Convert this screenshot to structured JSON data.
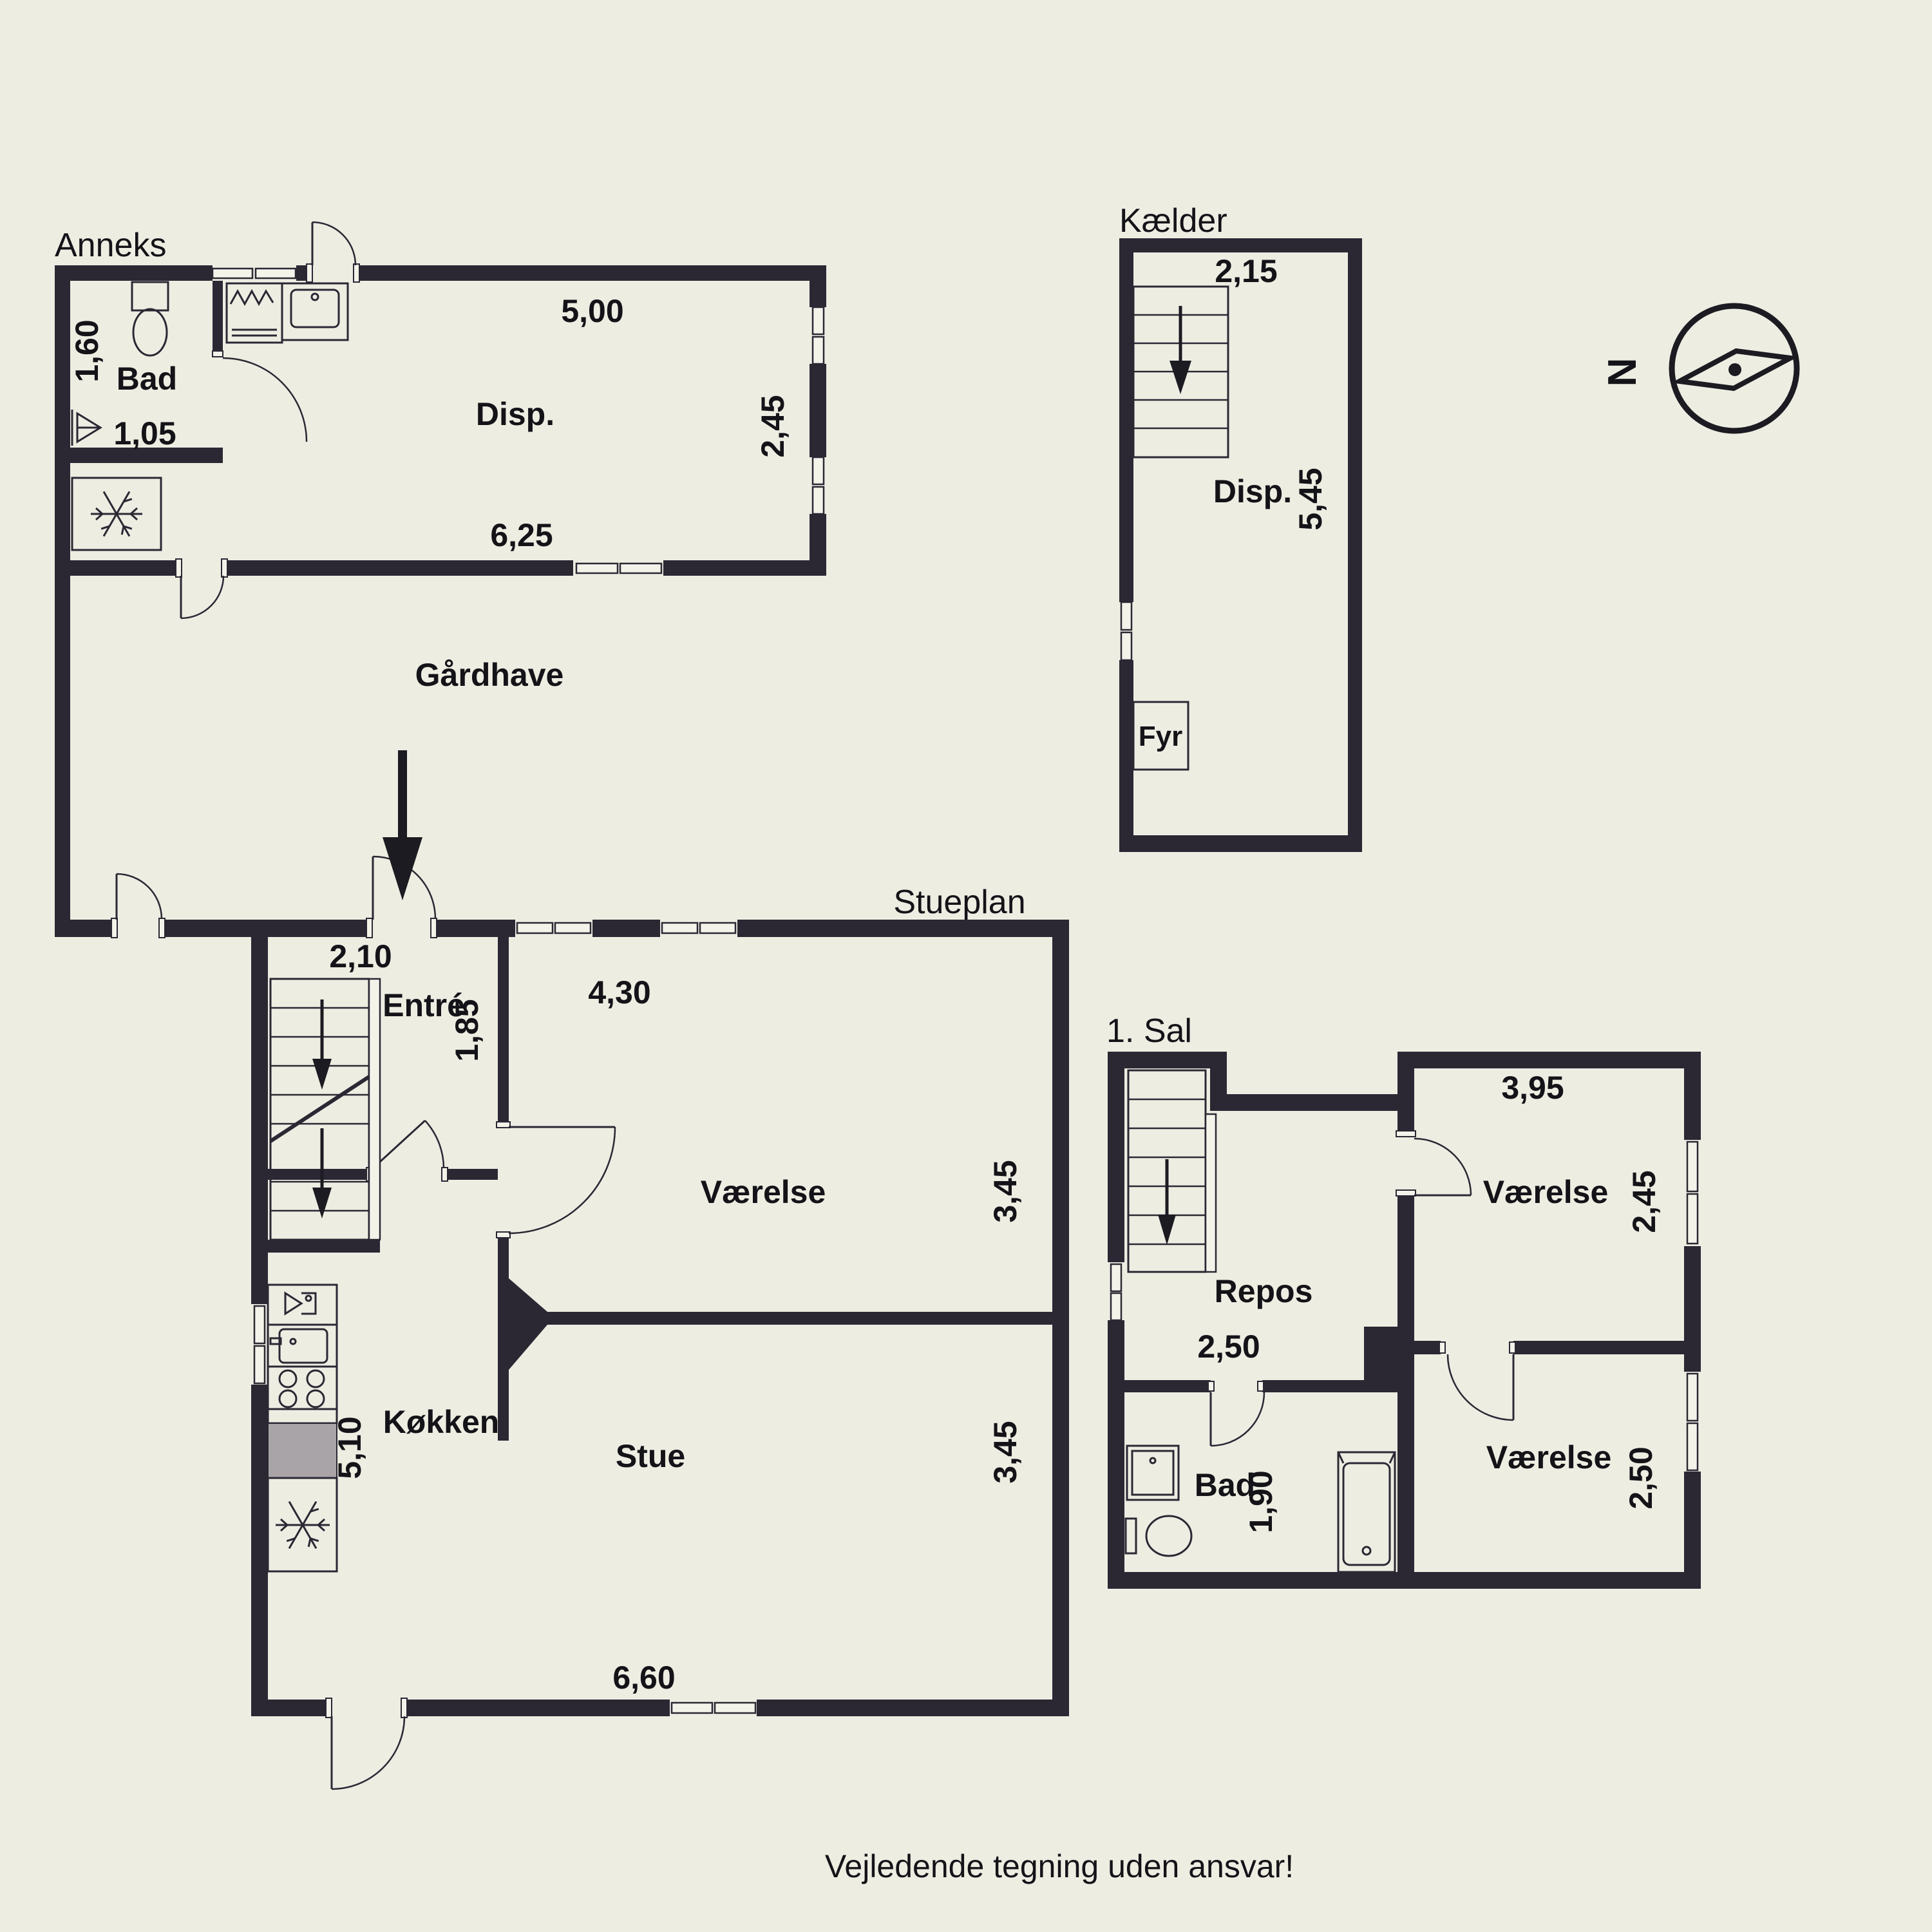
{
  "page": {
    "background": "#eeede2",
    "wall_color": "#2b2834",
    "footer": "Vejledende tegning uden ansvar!"
  },
  "compass": {
    "north_label": "N"
  },
  "anneks": {
    "title": "Anneks",
    "rooms": {
      "bad": "Bad",
      "disp": "Disp."
    },
    "dims": {
      "bad_height": "1,60",
      "bad_width": "1,05",
      "disp_top": "5,00",
      "disp_right": "2,45",
      "disp_bottom": "6,25"
    }
  },
  "kaelder": {
    "title": "Kælder",
    "rooms": {
      "disp": "Disp.",
      "fyr": "Fyr"
    },
    "dims": {
      "top": "2,15",
      "right": "5,45"
    }
  },
  "gaardhave": {
    "label": "Gårdhave"
  },
  "stueplan": {
    "title": "Stueplan",
    "rooms": {
      "entre": "Entré",
      "vaerelse": "Værelse",
      "koekken": "Køkken",
      "stue": "Stue"
    },
    "dims": {
      "entrance_width": "2,10",
      "entre_depth": "1,85",
      "vaerelse_width": "4,30",
      "vaerelse_height": "3,45",
      "koekken_height": "5,10",
      "stue_width": "6,60",
      "stue_height": "3,45"
    }
  },
  "foerstesal": {
    "title": "1. Sal",
    "rooms": {
      "repos": "Repos",
      "vaerelse_top": "Værelse",
      "vaerelse_bottom": "Værelse",
      "bad": "Bad"
    },
    "dims": {
      "repos_width": "2,50",
      "vaerelse_top_width": "3,95",
      "vaerelse_top_height": "2,45",
      "bad_height": "1,90",
      "vaerelse_bottom_height": "2,50"
    }
  }
}
